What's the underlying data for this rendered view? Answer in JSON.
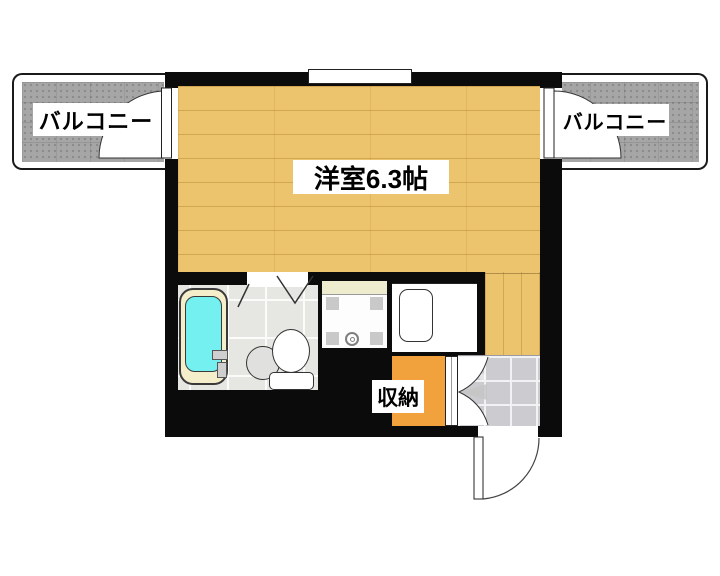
{
  "floor_plan": {
    "rooms": {
      "main_room": {
        "label": "洋室6.3帖",
        "floor": "wood"
      },
      "balcony_left": {
        "label": "バルコニー"
      },
      "balcony_right": {
        "label": "バルコニー"
      },
      "storage": {
        "label": "収納"
      },
      "bathroom": {
        "label": "",
        "fixtures": [
          "bathtub",
          "toilet",
          "sink",
          "faucet"
        ]
      },
      "laundry_nook": {
        "fixtures": [
          "washing-machine-pan",
          "drain"
        ]
      },
      "kitchen_nook": {
        "fixtures": [
          "kitchen-sink"
        ]
      },
      "entrance": {
        "floor": "tile",
        "fixtures": [
          "entrance-door"
        ]
      }
    },
    "doors": [
      "balcony-door-left",
      "balcony-door-right",
      "bathroom-folding-door",
      "storage-double-door",
      "entrance-swing-door"
    ],
    "colors": {
      "wall": "#0b0b0b",
      "wood": "#ecc46e",
      "balcony": "#a6a6a6",
      "bath-tile": "#e6e6e2",
      "entrance-tile": "#cbcbd0",
      "storage": "#f2a23d",
      "cream": "#eeeccf",
      "tub-rim": "#f4eecb",
      "water": "#74f0f0"
    }
  }
}
